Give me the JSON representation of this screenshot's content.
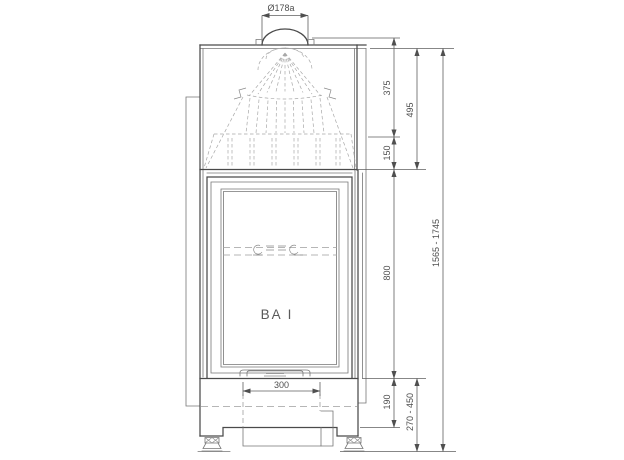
{
  "drawing_labels": {
    "model": "BA I",
    "collar_diameter": "Ø178a",
    "hood_upper_height": "375",
    "hood_total_height": "495",
    "hood_lower_height": "150",
    "door_height": "800",
    "overall_height": "1565 - 1745",
    "plinth_height": "190",
    "base_height_range": "270 - 450",
    "base_width": "300"
  },
  "colors": {
    "background": "#ffffff",
    "main_line": "#4a4a4a",
    "thin_line": "#767676",
    "hidden_line": "#a8a8a8",
    "dimension_line": "#5f5f5f",
    "text": "#4f4f4f"
  }
}
